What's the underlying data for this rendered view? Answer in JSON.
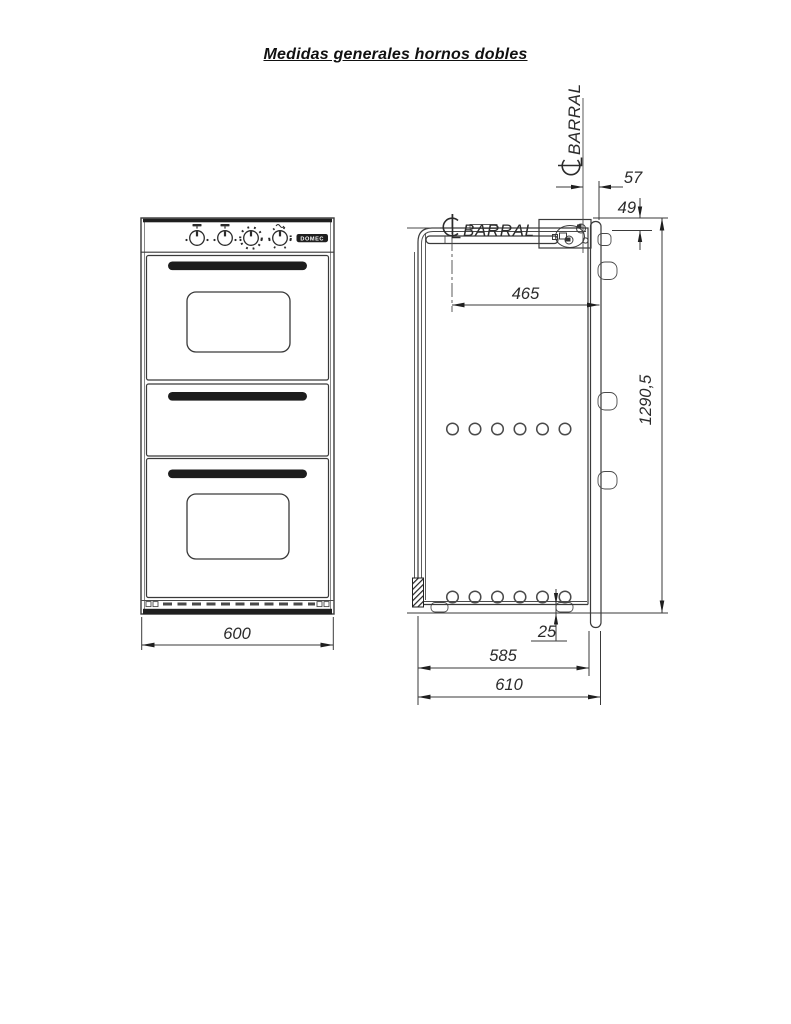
{
  "title": "Medidas generales hornos dobles",
  "front_view": {
    "brand": "DOMEC",
    "width_dim": "600"
  },
  "side_view": {
    "top_barral_label": "BARRAL",
    "front_barral_label": "BARRAL",
    "dims": {
      "barral_to_back": "57",
      "top_to_barral": "49",
      "barral_depth": "465",
      "total_height": "1290,5",
      "foot_height": "25",
      "body_depth": "585",
      "total_depth": "610"
    }
  }
}
